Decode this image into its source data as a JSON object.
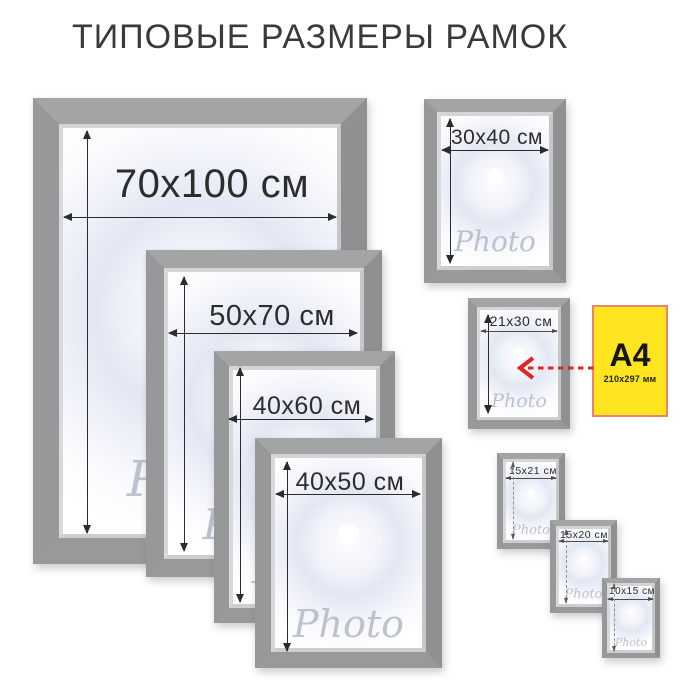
{
  "title": "ТИПОВЫЕ РАЗМЕРЫ РАМОК",
  "watermark": "Photo",
  "frames": {
    "f70x100": {
      "label": "70x100 см"
    },
    "f50x70": {
      "label": "50x70 см"
    },
    "f40x60": {
      "label": "40x60 см"
    },
    "f40x50": {
      "label": "40x50 см"
    },
    "f30x40": {
      "label": "30x40 см"
    },
    "f21x30": {
      "label": "21x30 см"
    },
    "f15x21": {
      "label": "15x21 см"
    },
    "f15x20": {
      "label": "15x20 см"
    },
    "f10x15": {
      "label": "10x15 см"
    }
  },
  "a4_note": {
    "label": "A4",
    "dimensions": "210x297 мм"
  },
  "colors": {
    "frame_gray": "#9a9c9e",
    "note_yellow": "#ffe51f",
    "note_border": "#ee8465",
    "arrow_red": "#e2231f",
    "dimension_text": "#2d2d2d",
    "watermark_gray": "#b7bcca"
  }
}
